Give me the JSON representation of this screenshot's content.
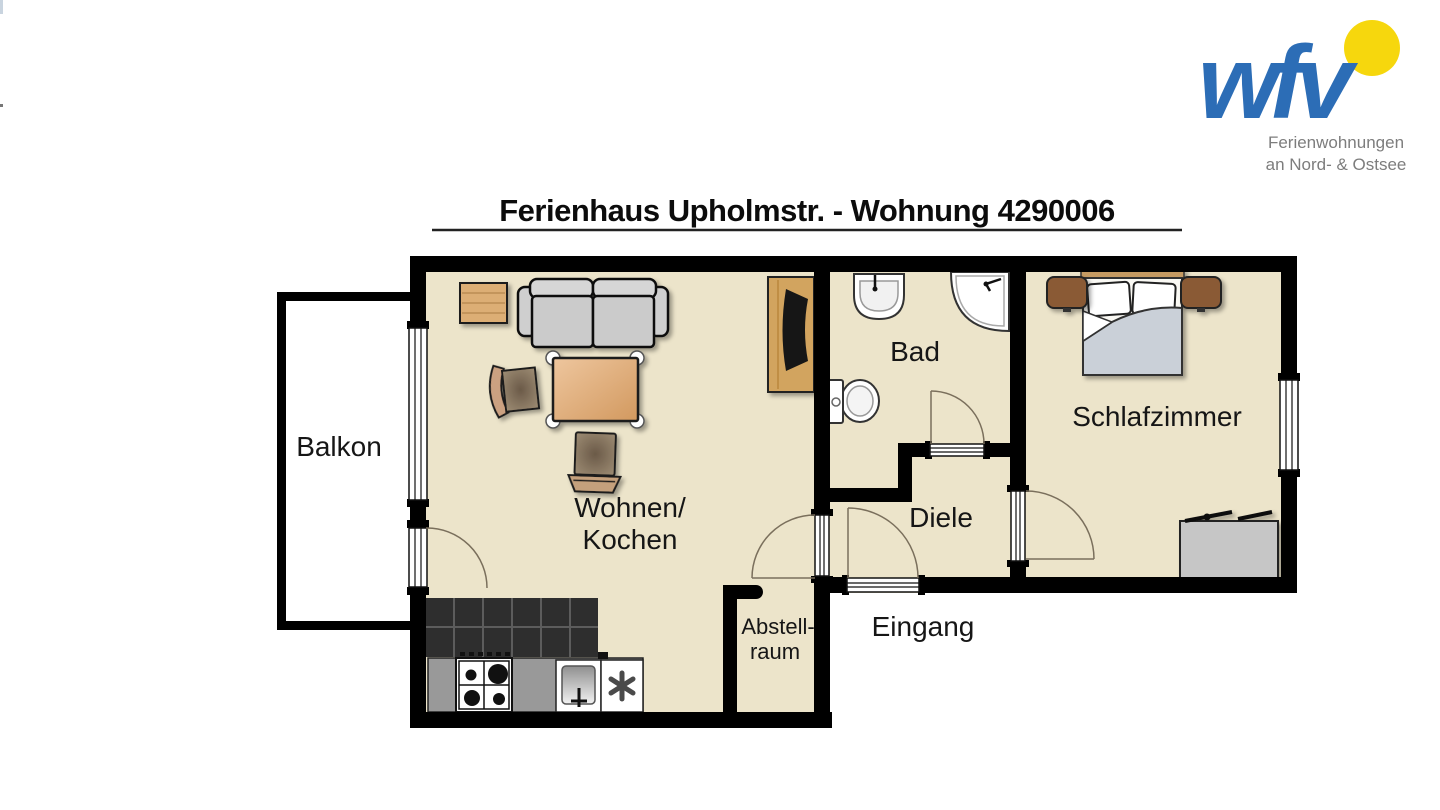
{
  "logo": {
    "wordmark": "wfv",
    "tagline_line1": "Ferienwohnungen",
    "tagline_line2": "an Nord- & Ostsee",
    "colors": {
      "wordmark_blue": "#2c6db6",
      "sun_yellow": "#f6d70d",
      "tagline_gray": "#7d7d7d"
    }
  },
  "title": {
    "text": "Ferienhaus Upholmstr. - Wohnung 4290006"
  },
  "floor_plan": {
    "rooms": {
      "balkon": {
        "label": "Balkon"
      },
      "wohnen_kochen": {
        "line1": "Wohnen/",
        "line2": "Kochen"
      },
      "bad": {
        "label": "Bad"
      },
      "diele": {
        "label": "Diele"
      },
      "schlafzimmer": {
        "label": "Schlafzimmer"
      },
      "abstellraum": {
        "line1": "Abstell-",
        "line2": "raum"
      },
      "eingang": {
        "label": "Eingang"
      }
    },
    "colors": {
      "floor": "#ece4ca",
      "wall": "#000000",
      "outside": "#ffffff",
      "kitchen_tile": "#2e2e2e",
      "kitchen_tile_line": "#5c5c5c",
      "counter_gray": "#999999",
      "wood_light": "#dcae74",
      "tv_board_wood": "#d2a45f",
      "sofa_gray": "#cfcfcf",
      "table_tan": "#e0ac7f",
      "seat_brown": "#8f7c64",
      "nightstand_brown": "#8a5a35",
      "blanket_gray": "#cad0d8",
      "dresser_gray": "#c6c6c6",
      "door_arc": "#7a6f5c"
    },
    "furniture_icons": [
      "sofa-icon",
      "side-table-icon",
      "armchair-icon",
      "dining-table-icon",
      "chair-icon",
      "tv-board-icon",
      "kitchen-tiles",
      "kitchen-counter-icon",
      "stove-icon",
      "kitchen-sink-icon",
      "dishwasher-icon",
      "bathroom-sink-icon",
      "corner-shower-icon",
      "toilet-icon",
      "double-bed-icon",
      "nightstand-icon",
      "dresser-icon"
    ]
  }
}
